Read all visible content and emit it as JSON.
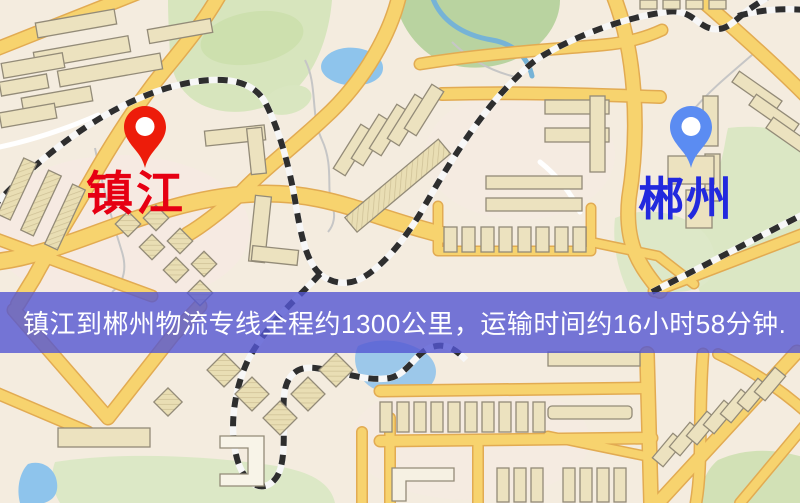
{
  "route_banner": {
    "text": "镇江到郴州物流专线全程约1300公里，运输时间约16小时58分钟.",
    "background_color": "#5456d2",
    "text_color": "#ffffff"
  },
  "route": {
    "origin": "镇江",
    "destination": "郴州",
    "distance_text": "约1300公里",
    "duration_text": "约16小时58分钟"
  },
  "markers": {
    "origin": {
      "label": "镇江",
      "pin_color": "#ed1c0a",
      "hole_color": "#ffffff",
      "label_color": "#e60013"
    },
    "destination": {
      "label": "郴州",
      "pin_color": "#5b8cf2",
      "hole_color": "#ffffff",
      "label_color": "#2229de"
    }
  },
  "map_palette": {
    "land": "#f4ecdf",
    "land_tint": "#f7e9e3",
    "park": "#d9e6c1",
    "park_dark": "#b9d3a0",
    "water": "#93c6ea",
    "stream": "#76b3d6",
    "road_fill": "#f7d36e",
    "road_casing": "#e2ab52",
    "minor_road": "#ffffff",
    "building": "#ece2bf",
    "building_outline": "#938b78",
    "railway_dark": "#2e2e2e",
    "railway_light": "#f7f7f7"
  }
}
